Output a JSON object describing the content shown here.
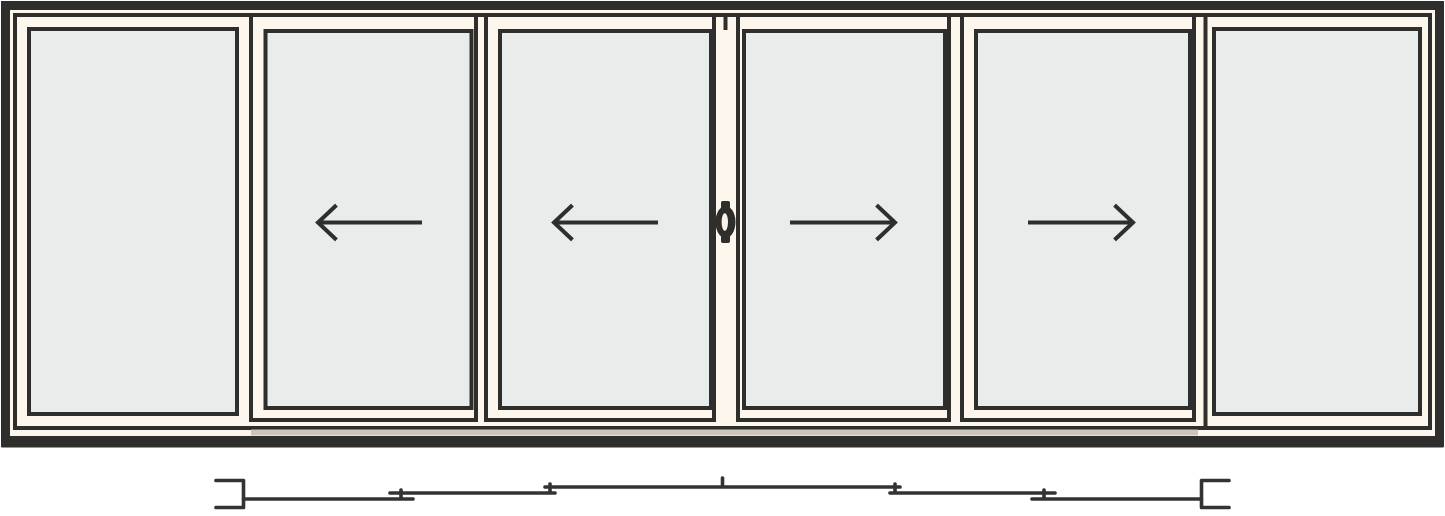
{
  "door": {
    "panel_count": 6,
    "configuration": "fixed / slide-left / slide-left / slide-right / slide-right / fixed",
    "panels": [
      {
        "id": 1,
        "type": "fixed"
      },
      {
        "id": 2,
        "type": "sliding",
        "slide_direction": "left"
      },
      {
        "id": 3,
        "type": "sliding",
        "slide_direction": "left"
      },
      {
        "id": 4,
        "type": "sliding",
        "slide_direction": "right"
      },
      {
        "id": 5,
        "type": "sliding",
        "slide_direction": "right"
      },
      {
        "id": 6,
        "type": "fixed"
      }
    ],
    "handle": {
      "location": "meeting stile between panels 3 and 4",
      "style": "oval flush pull"
    }
  },
  "track_diagram": {
    "shown": true,
    "style": "stepped stacking lines with end brackets",
    "segment_count": 6,
    "levels": 3
  },
  "colors": {
    "background": "#ffffff",
    "frame_outline": "#2e2e2c",
    "frame_fill": "#fcf6ed",
    "glass": "#e8eceb",
    "track": "#cdc5b9",
    "diagram_line": "#333333",
    "handle_slit": "#faf4ec"
  }
}
